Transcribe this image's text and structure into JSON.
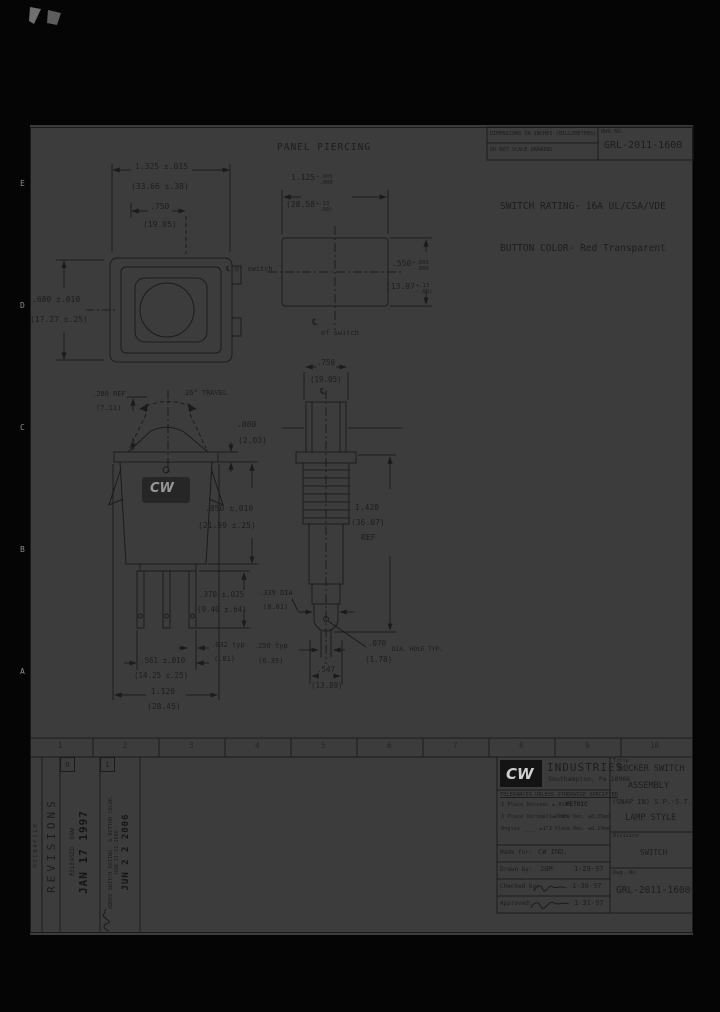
{
  "sheet": {
    "zones_bottom": [
      "1",
      "2",
      "3",
      "4",
      "5",
      "6",
      "7",
      "8",
      "9",
      "10"
    ],
    "zones_left": [
      "E",
      "D",
      "C",
      "B",
      "A"
    ]
  },
  "header": {
    "panel_piercing_title": "PANEL PIERCING",
    "dims_note_line1": "DIMENSIONS IN INCHES (MILLIMETERS)",
    "dims_note_line2": "DO NOT SCALE DRAWING",
    "dwg_no_label": "DWG NO.",
    "dwg_no": "GRL-2011-1600",
    "switch_rating": "SWITCH RATING- 16A UL/CSA/VDE",
    "button_color": "BUTTON COLOR- Red Transparent"
  },
  "labels": {
    "centerline_of_switch_1": "℄ of switch",
    "centerline_symbol_2": "℄",
    "centerline_of_switch_2": "of switch",
    "centerline_symbol_lamp": "℄",
    "travel": "26° TRAVEL",
    "dia_hole_typ": "DIA. HOLE TYP.",
    "lamp_ref": "REF"
  },
  "dims": {
    "bezel_width_in": "1.325 ±.015",
    "bezel_width_mm": "(33.66 ±.38)",
    "mount_width_in": ".750",
    "mount_width_mm": "(19.05)",
    "bezel_height_in": ".680 ±.010",
    "bezel_height_mm": "(17.27 ±.25)",
    "cutout_width_in": "1.125",
    "cutout_width_tol_up": "+.005",
    "cutout_width_tol_dn": "-.000",
    "cutout_width_mm": "(28.58",
    "cutout_width_mm_up": "+.13",
    "cutout_width_mm_dn": "-.00)",
    "cutout_height_in": ".550",
    "cutout_height_tol_up": "+.005",
    "cutout_height_tol_dn": "-.000",
    "cutout_height_mm": "(13.97",
    "cutout_height_mm_up": "+.13",
    "cutout_height_mm_dn": "-.00)",
    "rocker_proj_in": ".280 REF",
    "rocker_proj_mm": "(7.11)",
    "flange_thk_in": ".080",
    "flange_thk_mm": "(2.03)",
    "body_depth_in": ".850 ±.010",
    "body_depth_mm": "(21.59 ±.25)",
    "term_len_in": ".370 ±.025",
    "term_len_mm": "(9.40 ±.64)",
    "term_thk_in": ".032 typ",
    "term_thk_mm": "(.81)",
    "term_span_in": ".561 ±.010",
    "term_span_mm": "(14.25 ±.25)",
    "body_width_in": "1.120",
    "body_width_mm": "(28.45)",
    "lamp_top_in": ".750",
    "lamp_top_mm": "(19.05)",
    "lamp_len_in": "1.420",
    "lamp_len_mm": "(36.07)",
    "lamp_dia_in": ".339 DIA",
    "lamp_dia_mm": "(8.61)",
    "tip_offset_in": ".250 typ",
    "tip_offset_mm": "(6.35)",
    "tip_width_in": ".547",
    "tip_width_mm": "(13.89)",
    "hole_in": ".070",
    "hole_mm": "(1.78)"
  },
  "logo": {
    "mark": "CW"
  },
  "title_block": {
    "company": "INDUSTRIES",
    "address": "Southampton, Pa 18966",
    "tol_header": "TOLERANCES UNLESS OTHERWISE SPECIFIED",
    "tol_2place": "2 Place Decimal ±.010",
    "tol_3place": "3 Place Decimal ±.005",
    "tol_angles": "Angles ____ ±1°",
    "metric": "METRIC",
    "metric_1place": "1 Place Dec. ±0.25mm",
    "metric_2place": "2 Place Dec. ±0.13mm",
    "made_for_label": "Made for:",
    "made_for": "CW IND.",
    "drawn_by_label": "Drawn by:",
    "drawn_by": "JGM",
    "drawn_date": "1-29-97",
    "checked_by_label": "Checked by:",
    "checked_date": "1-30-97",
    "approved_label": "Approved:",
    "approved_date": "1-31-97",
    "title_label": "Title",
    "title_line1": "ROCKER SWITCH",
    "title_line2": "ASSEMBLY",
    "title_line3": "(SNAP IN) S.P.-S.T.",
    "title_line4": "LAMP STYLE",
    "division_label": "Division",
    "division": "SWITCH",
    "dwg_no_label": "Dwg. No.",
    "dwg_no": "GRL-2011-1600"
  },
  "revisions": {
    "header": "REVISIONS",
    "microfilm": "MICROFILM",
    "rev0_id": "O",
    "rev0_desc": "RELEASED",
    "rev0_by": "DGW",
    "rev0_stamp": "JAN 17 1997",
    "rev1_id": "1",
    "rev1_desc1": "ADDED SWITCH RATING",
    "rev1_desc2": "& BUTTON COLOR.",
    "rev1_by": "DGW  11-21-2006",
    "rev1_stamp": "JUN 2 2 2006"
  }
}
